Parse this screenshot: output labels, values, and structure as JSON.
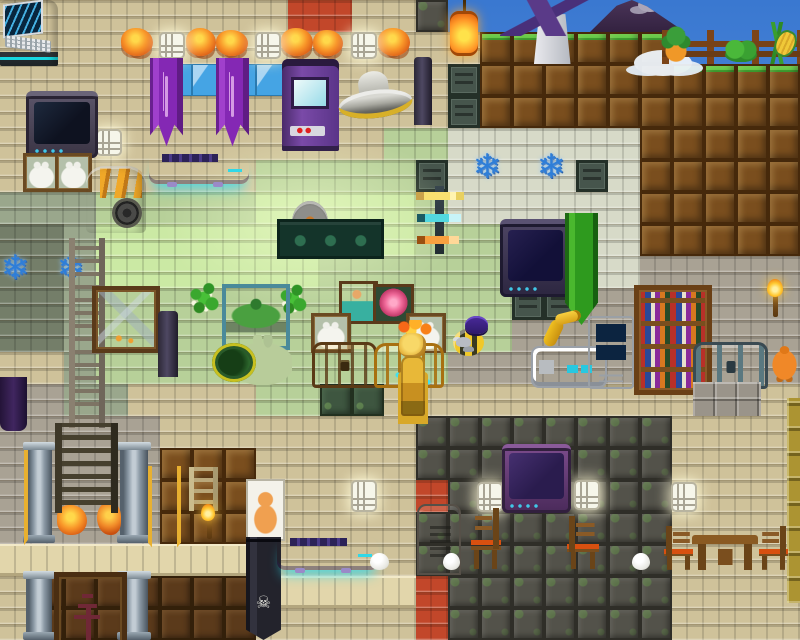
{
  "scene": {
    "label": "2D tile-based sandbox game world",
    "width": 800,
    "height": 640,
    "tile_size": 32
  },
  "palette": {
    "sky_top": "#3a78d0",
    "sky_bottom": "#76b0ec",
    "beige_brick": "#cfc29a",
    "green_brick": "#b7d099",
    "bright_green_brick": "#cbe9a4",
    "sage_brick": "#9aa78c",
    "olive_brick": "#747e69",
    "pale_brick": "#d7dac8",
    "gray_brick": "#a9a294",
    "red_brick": "#c2472a",
    "dirt": "#7a4e1e",
    "grass": "#52c73e",
    "dark_stone": "#53524a",
    "mossy_stone": "#3e5640",
    "dark_dirt": "#5b3a1b",
    "window_glass": "#45a4e4",
    "stone_slab": "#e2d6ab",
    "metal_vent": "#46554c",
    "banner_purple": "#8428b4",
    "banner_green": "#2e9a1e",
    "flag_orange": "#f08828",
    "gold": "#f0b028",
    "hover_glow_cyan": "#30d8e8"
  },
  "map": {
    "legend": {
      "B": "beige-brick",
      "G": "green-brick",
      "H": "bright-green-brick",
      "g": "sage-brick",
      "o": "olive-brick",
      "W": "pale-brick",
      "S": "gray-brick",
      "R": "red-brick",
      "d": "dirt",
      "T": "grass-dirt",
      "N": "dark-dirt",
      "D": "dark-stone",
      "E": "mossy-stone",
      "V": "window-glass",
      "L": "stone-slab",
      "M": "metal-vent",
      "K": "sky"
    },
    "tiles": [
      "BBBBBBBBBRRBBDKKKKKKKKKKK",
      "BBBBBBBBBBBBBBBTTTTTTKKKK",
      "BBBBBVVVVBBBBBMddddddTTTT",
      "BBBBBBBBBBBBBBMdddddddddd",
      "BBBBBBBBBBBBGGWWWWWWddddd",
      "BBBBBBBBGGGGGMWWWWMWddddd",
      "gggGGGGGHHHHHGWWWWWWddddd",
      "oogHHHHHHHHHHGGGGGWWddddd",
      "oogHHHHHHHGGGGGGGGWWSSSSS",
      "oogGGGGGGGGGGGGGMMSSSSSSS",
      "oogGGGGGGGGGGGGGSSSSSSSSS",
      "BBgGGGGGGGGGGGSSSSSSSSSSS",
      "SSggBBBBGGEEBBBBBBBBBBBBB",
      "SSSSSBBBBBBBBDDDDDDDDBBBB",
      "SSSSSdddBBBBBDDDDDDDDBBBB",
      "SSSSSdddBBBBBRDDDDDDDBBBB",
      "SSSSSdddBBBBBDDDDDDDDBBBB",
      "LLLLLLLLBBBBBDDDDDDDDBBBB",
      "BNNNNNNNLLLLLRDDDDDDDBBBB",
      "BNNNNNNNBBBBBRDDDDDDDBBBB"
    ]
  },
  "items": [
    {
      "n": "light-glow",
      "x": 150,
      "y": 140,
      "w": 320,
      "h": 180,
      "i": false
    },
    {
      "n": "windmill",
      "x": 495,
      "y": 0,
      "w": 118,
      "h": 64,
      "i": false
    },
    {
      "n": "volcano",
      "x": 590,
      "y": 0,
      "w": 95,
      "h": 32,
      "i": false
    },
    {
      "n": "cloud",
      "x": 634,
      "y": 50,
      "w": 58,
      "h": 26,
      "i": false
    },
    {
      "n": "lantern",
      "x": 446,
      "y": 0,
      "w": 36,
      "h": 60,
      "i": false
    },
    {
      "n": "farm-fence",
      "x": 662,
      "y": 30,
      "w": 138,
      "h": 34,
      "i": false
    },
    {
      "n": "pineapple-plant",
      "x": 660,
      "y": 24,
      "w": 32,
      "h": 40,
      "i": false
    },
    {
      "n": "bush",
      "x": 724,
      "y": 40,
      "w": 34,
      "h": 22,
      "i": false
    },
    {
      "n": "corn-plant",
      "x": 756,
      "y": 22,
      "w": 42,
      "h": 42,
      "i": false
    },
    {
      "n": "science-machine",
      "x": 0,
      "y": 0,
      "w": 58,
      "h": 66,
      "i": true
    },
    {
      "n": "fire-lamp",
      "x": 121,
      "y": 28,
      "w": 32,
      "h": 28,
      "i": false
    },
    {
      "n": "fire-lamp",
      "x": 186,
      "y": 28,
      "w": 30,
      "h": 28,
      "i": false
    },
    {
      "n": "fire-lamp",
      "x": 216,
      "y": 30,
      "w": 32,
      "h": 26,
      "i": false
    },
    {
      "n": "fire-lamp",
      "x": 281,
      "y": 28,
      "w": 32,
      "h": 28,
      "i": false
    },
    {
      "n": "fire-lamp",
      "x": 313,
      "y": 30,
      "w": 30,
      "h": 26,
      "i": false
    },
    {
      "n": "fire-lamp",
      "x": 378,
      "y": 28,
      "w": 32,
      "h": 28,
      "i": false
    },
    {
      "n": "wall-light",
      "x": 159,
      "y": 32,
      "w": 22,
      "h": 23,
      "i": false
    },
    {
      "n": "wall-light",
      "x": 255,
      "y": 32,
      "w": 22,
      "h": 23,
      "i": false
    },
    {
      "n": "wall-light",
      "x": 351,
      "y": 32,
      "w": 22,
      "h": 23,
      "i": false
    },
    {
      "n": "wall-light",
      "x": 96,
      "y": 129,
      "w": 22,
      "h": 23,
      "i": false
    },
    {
      "n": "purple-banner",
      "x": 150,
      "y": 58,
      "w": 33,
      "h": 90,
      "i": false
    },
    {
      "n": "purple-banner",
      "x": 216,
      "y": 58,
      "w": 33,
      "h": 90,
      "i": false
    },
    {
      "n": "arcade-machine",
      "x": 282,
      "y": 59,
      "w": 57,
      "h": 92,
      "i": true
    },
    {
      "n": "saucer",
      "x": 338,
      "y": 75,
      "w": 74,
      "h": 48,
      "i": true
    },
    {
      "n": "dark-pole",
      "x": 414,
      "y": 57,
      "w": 18,
      "h": 68,
      "i": false
    },
    {
      "n": "tv-dark",
      "x": 26,
      "y": 91,
      "w": 72,
      "h": 62,
      "i": true
    },
    {
      "n": "bunny-picture",
      "x": 23,
      "y": 153,
      "w": 31,
      "h": 33,
      "i": false
    },
    {
      "n": "bunny-picture",
      "x": 55,
      "y": 153,
      "w": 31,
      "h": 33,
      "i": false
    },
    {
      "n": "generator",
      "x": 86,
      "y": 166,
      "w": 60,
      "h": 67,
      "i": true
    },
    {
      "n": "hoverbed",
      "x": 149,
      "y": 151,
      "w": 100,
      "h": 33,
      "i": true
    },
    {
      "n": "blue-crystal",
      "x": -2,
      "y": 249,
      "w": 34,
      "h": 38,
      "i": false
    },
    {
      "n": "blue-crystal",
      "x": 54,
      "y": 249,
      "w": 34,
      "h": 38,
      "i": false
    },
    {
      "n": "blue-crystal",
      "x": 466,
      "y": 148,
      "w": 42,
      "h": 44,
      "i": false
    },
    {
      "n": "blue-crystal",
      "x": 530,
      "y": 148,
      "w": 42,
      "h": 44,
      "i": false
    },
    {
      "n": "sword-rack",
      "x": 414,
      "y": 186,
      "w": 52,
      "h": 68,
      "i": false
    },
    {
      "n": "gear-trophy",
      "x": 292,
      "y": 201,
      "w": 36,
      "h": 21,
      "i": false
    },
    {
      "n": "butterfly-case",
      "x": 277,
      "y": 219,
      "w": 101,
      "h": 34,
      "i": false
    },
    {
      "n": "tv-blue",
      "x": 500,
      "y": 219,
      "w": 71,
      "h": 73,
      "i": true
    },
    {
      "n": "green-banner",
      "x": 565,
      "y": 213,
      "w": 33,
      "h": 112,
      "i": false
    },
    {
      "n": "ladder-tall",
      "x": 69,
      "y": 238,
      "w": 36,
      "h": 190,
      "i": true
    },
    {
      "n": "green-sprig",
      "x": 184,
      "y": 281,
      "w": 40,
      "h": 38,
      "i": false
    },
    {
      "n": "green-sprig",
      "x": 276,
      "y": 283,
      "w": 34,
      "h": 36,
      "i": false
    },
    {
      "n": "painting-mountain",
      "x": 92,
      "y": 286,
      "w": 60,
      "h": 59,
      "i": false
    },
    {
      "n": "painting-island",
      "x": 222,
      "y": 284,
      "w": 60,
      "h": 58,
      "i": false
    },
    {
      "n": "painting-portrait",
      "x": 339,
      "y": 281,
      "w": 33,
      "h": 37,
      "i": false
    },
    {
      "n": "painting-rose",
      "x": 373,
      "y": 284,
      "w": 35,
      "h": 34,
      "i": false
    },
    {
      "n": "bunny-picture",
      "x": 311,
      "y": 313,
      "w": 34,
      "h": 34,
      "i": false
    },
    {
      "n": "bunny-picture",
      "x": 406,
      "y": 313,
      "w": 34,
      "h": 34,
      "i": false
    },
    {
      "n": "dark-pole",
      "x": 158,
      "y": 311,
      "w": 20,
      "h": 66,
      "i": false
    },
    {
      "n": "bunny-shell-pet",
      "x": 212,
      "y": 335,
      "w": 80,
      "h": 50,
      "i": true
    },
    {
      "n": "chest-wood",
      "x": 312,
      "y": 342,
      "w": 59,
      "h": 40,
      "i": true
    },
    {
      "n": "chest-gold",
      "x": 374,
      "y": 343,
      "w": 64,
      "h": 39,
      "i": true
    },
    {
      "n": "player-gold",
      "x": 388,
      "y": 320,
      "w": 50,
      "h": 100,
      "i": true
    },
    {
      "n": "bee-pet",
      "x": 450,
      "y": 316,
      "w": 52,
      "h": 50,
      "i": true
    },
    {
      "n": "lab-station",
      "x": 531,
      "y": 346,
      "w": 72,
      "h": 38,
      "i": true
    },
    {
      "n": "robot-arm",
      "x": 543,
      "y": 313,
      "w": 48,
      "h": 40,
      "i": true
    },
    {
      "n": "computer-tower",
      "x": 588,
      "y": 316,
      "w": 42,
      "h": 69,
      "i": true
    },
    {
      "n": "bookshelf",
      "x": 634,
      "y": 285,
      "w": 68,
      "h": 100,
      "i": true
    },
    {
      "n": "chest-steel",
      "x": 693,
      "y": 342,
      "w": 69,
      "h": 41,
      "i": true
    },
    {
      "n": "stone-slabs",
      "x": 693,
      "y": 382,
      "w": 68,
      "h": 34,
      "i": false
    },
    {
      "n": "torch",
      "x": 761,
      "y": 279,
      "w": 28,
      "h": 40,
      "i": false
    },
    {
      "n": "orange-pet",
      "x": 769,
      "y": 344,
      "w": 31,
      "h": 38,
      "i": true
    },
    {
      "n": "gold-strip",
      "x": 787,
      "y": 398,
      "w": 13,
      "h": 205,
      "i": false
    },
    {
      "n": "purple-curtain",
      "x": 0,
      "y": 377,
      "w": 27,
      "h": 54,
      "i": false
    },
    {
      "n": "stone-column",
      "x": 26,
      "y": 442,
      "w": 26,
      "h": 101,
      "i": false
    },
    {
      "n": "stone-column",
      "x": 120,
      "y": 442,
      "w": 28,
      "h": 101,
      "i": false
    },
    {
      "n": "stone-column",
      "x": 26,
      "y": 571,
      "w": 26,
      "h": 69,
      "i": false
    },
    {
      "n": "stone-column",
      "x": 120,
      "y": 571,
      "w": 28,
      "h": 69,
      "i": false
    },
    {
      "n": "orange-flag",
      "x": -4,
      "y": 450,
      "w": 32,
      "h": 112,
      "i": false
    },
    {
      "n": "orange-flag",
      "x": 148,
      "y": 466,
      "w": 33,
      "h": 96,
      "i": false
    },
    {
      "n": "fire-decor",
      "x": 57,
      "y": 502,
      "w": 66,
      "h": 36,
      "i": false
    },
    {
      "n": "dark-ladder",
      "x": 55,
      "y": 423,
      "w": 63,
      "h": 90,
      "i": true
    },
    {
      "n": "small-ladder",
      "x": 189,
      "y": 467,
      "w": 29,
      "h": 44,
      "i": true
    },
    {
      "n": "torch",
      "x": 196,
      "y": 504,
      "w": 24,
      "h": 36,
      "i": false
    },
    {
      "n": "cat-poster",
      "x": 246,
      "y": 479,
      "w": 35,
      "h": 58,
      "i": false
    },
    {
      "n": "skull-banner",
      "x": 246,
      "y": 537,
      "w": 35,
      "h": 103,
      "i": false
    },
    {
      "n": "painting-pagoda",
      "x": 54,
      "y": 572,
      "w": 63,
      "h": 68,
      "i": false
    },
    {
      "n": "wall-light",
      "x": 351,
      "y": 480,
      "w": 22,
      "h": 28,
      "i": false
    },
    {
      "n": "wall-light",
      "x": 477,
      "y": 482,
      "w": 22,
      "h": 26,
      "i": false
    },
    {
      "n": "wall-light",
      "x": 574,
      "y": 480,
      "w": 22,
      "h": 26,
      "i": false
    },
    {
      "n": "wall-light",
      "x": 671,
      "y": 482,
      "w": 22,
      "h": 26,
      "i": false
    },
    {
      "n": "hoverbed",
      "x": 277,
      "y": 535,
      "w": 102,
      "h": 35,
      "i": true
    },
    {
      "n": "metal-door",
      "x": 417,
      "y": 504,
      "w": 40,
      "h": 67,
      "i": true
    },
    {
      "n": "tv-purple",
      "x": 502,
      "y": 444,
      "w": 69,
      "h": 65,
      "i": true
    },
    {
      "n": "chair",
      "x": 471,
      "y": 508,
      "w": 30,
      "h": 61,
      "i": true,
      "f": 1
    },
    {
      "n": "chair",
      "x": 567,
      "y": 516,
      "w": 32,
      "h": 53,
      "i": true
    },
    {
      "n": "chair",
      "x": 664,
      "y": 526,
      "w": 29,
      "h": 44,
      "i": true
    },
    {
      "n": "chair",
      "x": 759,
      "y": 526,
      "w": 29,
      "h": 44,
      "i": true,
      "f": 1
    },
    {
      "n": "table",
      "x": 692,
      "y": 535,
      "w": 66,
      "h": 35,
      "i": false
    },
    {
      "n": "egg",
      "x": 370,
      "y": 553,
      "w": 19,
      "h": 17,
      "i": false
    },
    {
      "n": "egg",
      "x": 443,
      "y": 553,
      "w": 17,
      "h": 17,
      "i": false
    },
    {
      "n": "egg",
      "x": 632,
      "y": 553,
      "w": 18,
      "h": 17,
      "i": false
    }
  ]
}
